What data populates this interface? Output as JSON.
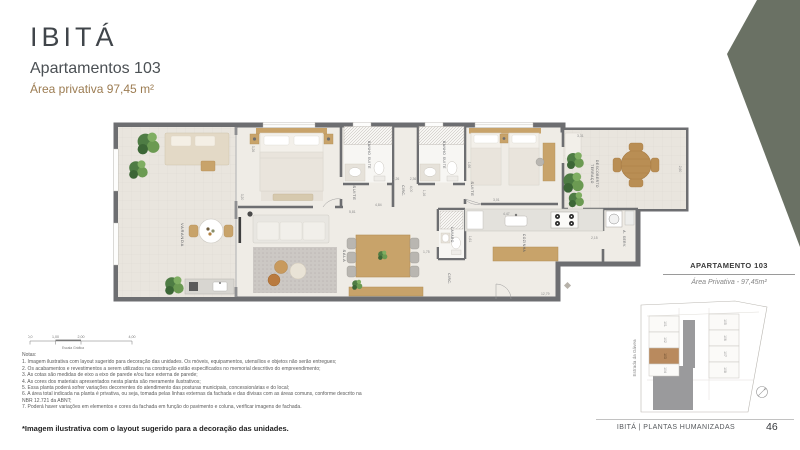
{
  "header": {
    "brand": "IBITÁ",
    "subtitle": "Apartamentos 103",
    "area": "Área privativa 97,45 m²"
  },
  "plan": {
    "rooms": {
      "varanda": "VARANDA",
      "suite_master": "SUITE",
      "banho_suite_1": "BANHO SUITE",
      "circ_upper": "CIRC.",
      "banho_suite_2": "BANHO SUITE",
      "suite_2": "SUITE",
      "terraco_line1": "TERRAÇO",
      "terraco_line2": "DESCOBERTO",
      "sala": "SALA",
      "lavabo": "LAVABO",
      "circ_lower": "CIRC.",
      "cozinha": "COZINHA",
      "area_servico": "A. SERV."
    },
    "dims": [
      "3,26",
      "3,20",
      "5,81",
      "4,84",
      "4,00",
      "2,26",
      "2,36",
      "1,16",
      "1,66",
      "3,01",
      "4,47",
      "3,31",
      "2,60",
      "2,15",
      "1,75",
      "1,61",
      "12,79"
    ]
  },
  "scale_bar": {
    "ticks": [
      "0,0",
      "1,00",
      "2,00",
      "4,00"
    ],
    "label": "Escala Gráfica"
  },
  "notes": {
    "title": "Notas:",
    "items": [
      "1. Imagem ilustrativa com layout sugerido para decoração das unidades. Os móveis, equipamentos, utensílios e objetos não serão entregues;",
      "2. Os acabamentos e revestimentos a serem utilizados na construção estão especificados no memorial descritivo do empreendimento;",
      "3. As cotas são medidas de eixo a eixo de parede e/ou face externa de parede;",
      "4. As cores dos materiais apresentados nesta planta são meramente ilustrativos;",
      "5. Essa planta poderá sofrer variações decorrentes do atendimento das posturas municipais, concessionárias e do local;",
      "6. A área total indicada na planta é privativa, ou seja, tomada pelas linhas externas da fachada e das divisas com as áreas comuns, conforme descrito na NBR 12.721 da ABNT;",
      "7. Poderá haver variações em elementos e cores da fachada em função do pavimento e coluna, verificar imagens de fachada."
    ]
  },
  "info_box": {
    "title": "APARTAMENTO 103",
    "area": "Área Privativa - 97,45m²"
  },
  "site_plan": {
    "street": "Estrada da Gávea",
    "units_left": [
      "101",
      "102",
      "103",
      "104"
    ],
    "units_right": [
      "105",
      "106",
      "107",
      "108"
    ],
    "highlighted_unit": "103"
  },
  "footer": {
    "disclaimer": "*Imagem ilustrativa com o layout sugerido para a decoração das unidades.",
    "brand_line": "IBITÁ | PLANTAS HUMANIZADAS",
    "page": "46"
  },
  "colors": {
    "accent_wedge": "#6A7164",
    "area_text": "#9C7C52",
    "wall": "#6D6E71",
    "wood": "#C8A36A",
    "highlight_unit": "#B98A5E"
  }
}
